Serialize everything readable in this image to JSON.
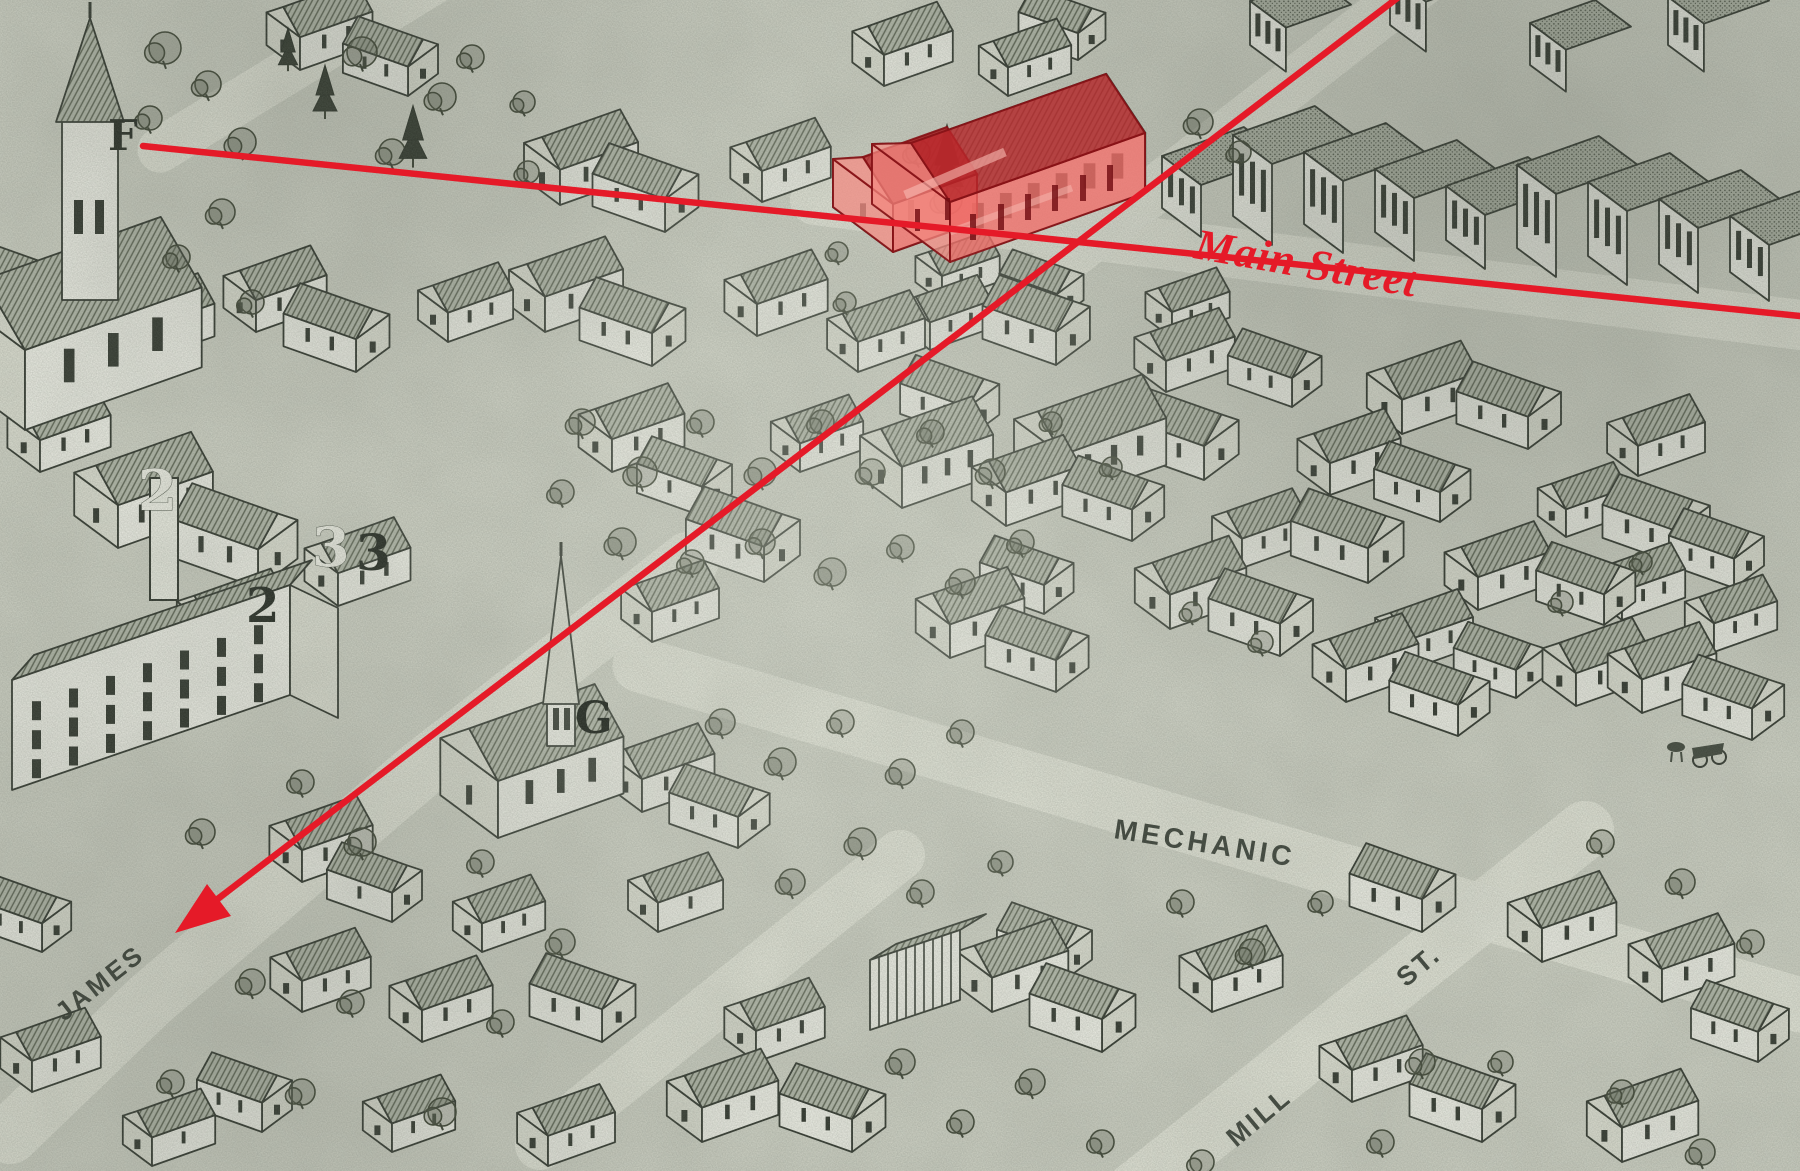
{
  "map": {
    "kind": "engraved birds-eye town panorama with red overlay annotations",
    "colors": {
      "annotation_red": "#e51a28",
      "highlight_wall": "rgba(240,108,102,0.78)",
      "highlight_wall_side": "rgba(244,136,128,0.72)",
      "highlight_roof": "rgba(186,38,42,0.78)",
      "ink": "#2a3027",
      "paper": "#d2d5c8"
    },
    "overlay_labels": {
      "main_street": "Main Street"
    },
    "street_names": {
      "mechanic": "MECHANIC",
      "mill": "MILL",
      "mill_suffix": "ST.",
      "james": "JAMES"
    },
    "reference_letters": {
      "f": "F",
      "g": "G"
    },
    "plot_numbers": {
      "white_2": "2",
      "white_3": "3",
      "dark_3": "3",
      "dark_2": "2"
    }
  }
}
